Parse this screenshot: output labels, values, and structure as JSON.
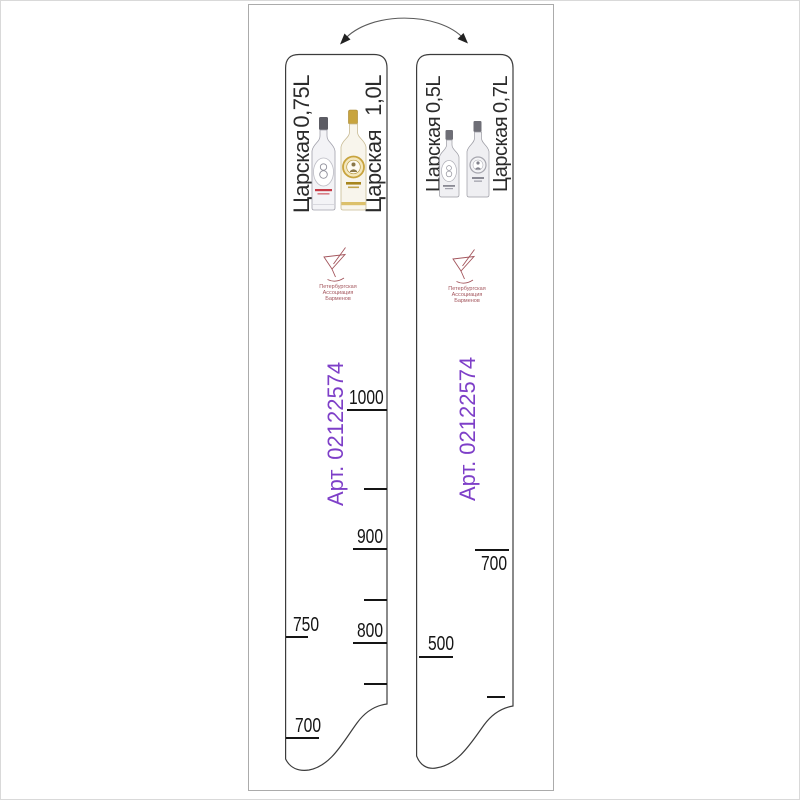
{
  "colors": {
    "accent_purple": "#7e3fc8",
    "logo_red": "#a3555c",
    "tick_black": "#151515",
    "gold_cap": "#c8a43e",
    "frame_gray": "#ababab"
  },
  "icons": {
    "flip_arrow": "curved-double-headed-arrow",
    "logo": "cocktail-glass-line-art",
    "bottles_left": "two-tsarskaya-vodka-bottles-color",
    "bottles_right": "two-tsarskaya-vodka-bottles-grayscale"
  },
  "strips": [
    {
      "name": "bar-level-strip-0.75L-1.0L",
      "left_label": {
        "brand": "Царская",
        "volume": "0,75L"
      },
      "right_label": {
        "brand": "Царская",
        "volume": "1,0L"
      },
      "art_number": "Арт. 02122574",
      "logo": {
        "line1": "Петербургская",
        "line2": "Ассоциация",
        "line3": "Барменов"
      },
      "right_scale": {
        "t1000": "1000",
        "t900": "900",
        "t800": "800"
      },
      "left_scale": {
        "t750": "750",
        "t700": "700"
      }
    },
    {
      "name": "bar-level-strip-0.5L-0.7L",
      "left_label": {
        "brand": "Царская",
        "volume": "0,5L"
      },
      "right_label": {
        "brand": "Царская",
        "volume": "0,7L"
      },
      "art_number": "Арт. 02122574",
      "logo": {
        "line1": "Петербургская",
        "line2": "Ассоциация",
        "line3": "Барменов"
      },
      "right_scale": {
        "t700": "700"
      },
      "left_scale": {
        "t500": "500"
      }
    }
  ]
}
